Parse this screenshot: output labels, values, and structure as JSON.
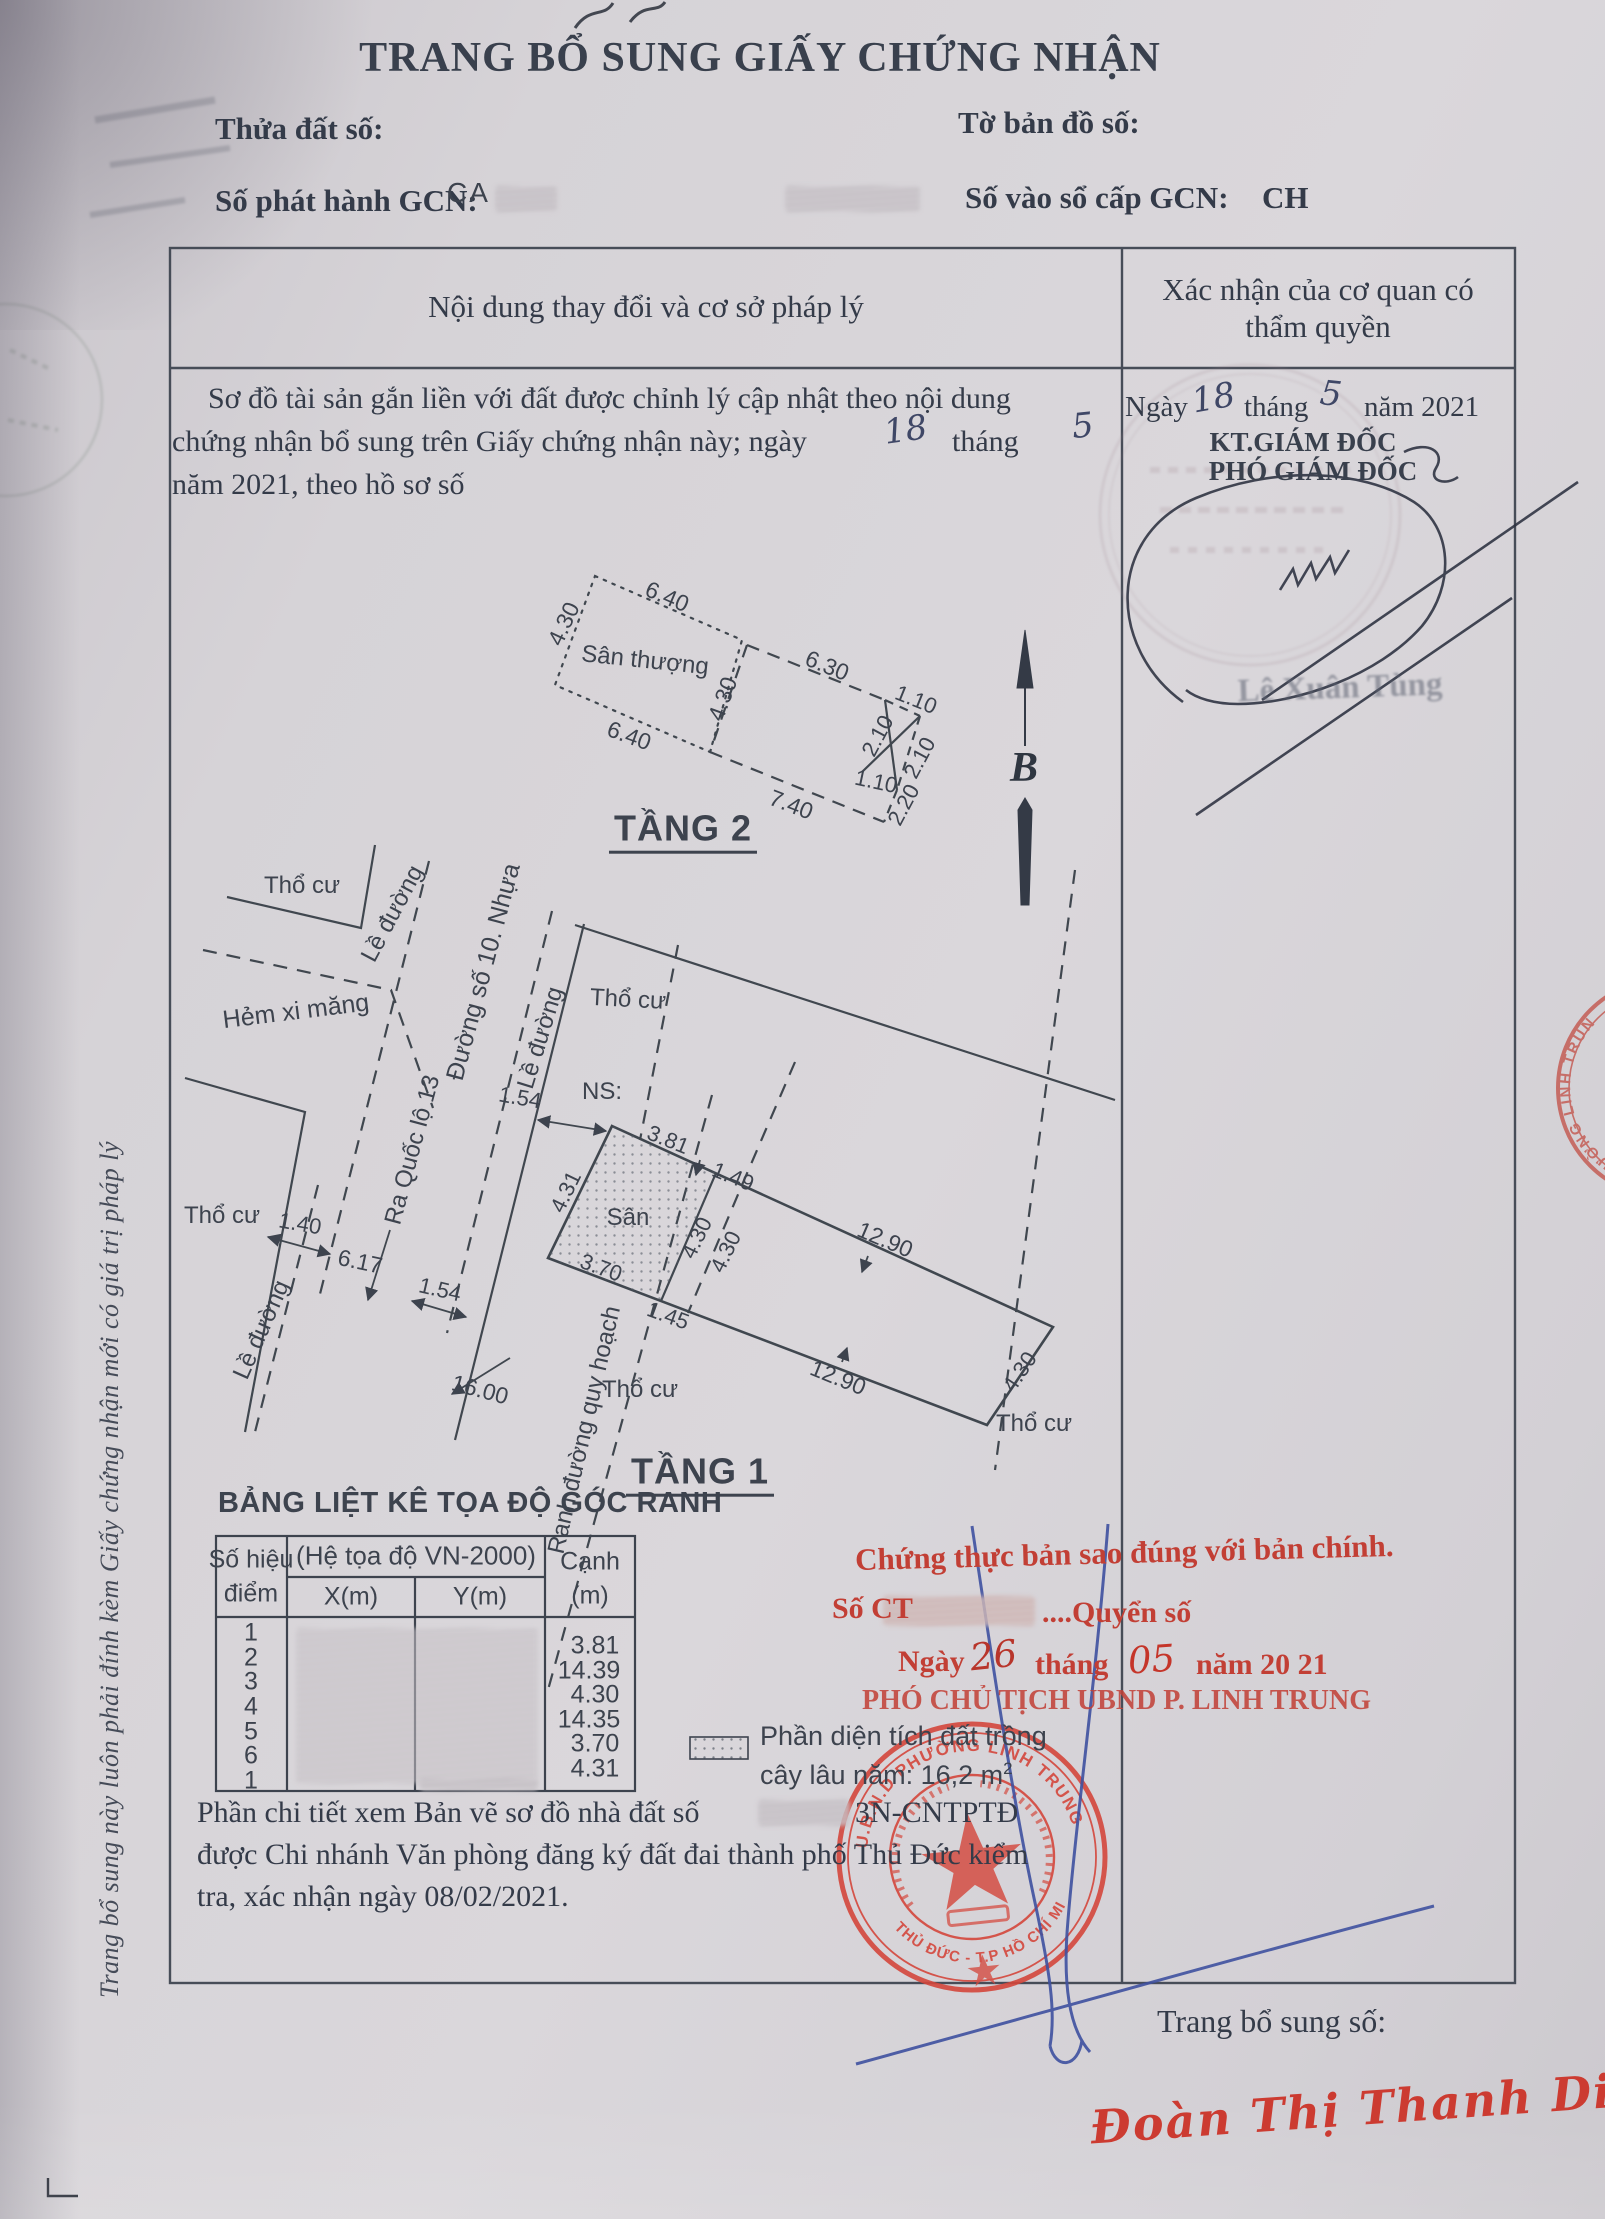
{
  "page": {
    "title": "TRANG BỔ SUNG GIẤY CHỨNG NHẬN",
    "footer_label": "Trang bổ sung số:",
    "side_note": "Trang bổ sung này luôn phải đính kèm Giấy chứng nhận mới có giá trị pháp lý"
  },
  "fields": {
    "thua_dat": "Thửa đất số:",
    "to_ban_do": "Tờ bản đồ số:",
    "so_phat_hanh": "Số phát hành GCN:",
    "so_phat_hanh_value": "CA",
    "so_vao_so": "Số vào sổ cấp GCN:",
    "so_vao_so_value": "CH"
  },
  "table": {
    "col_left": "Nội dung thay đổi và cơ sở pháp lý",
    "col_right_1": "Xác nhận của cơ quan có",
    "col_right_2": "thẩm quyền"
  },
  "entry": {
    "line1": "Sơ đồ tài sản gắn liền với đất được chỉnh lý cập nhật theo nội dung",
    "line2a": "chứng nhận bổ sung trên Giấy chứng nhận này; ngày",
    "hand_day": "18",
    "line2b": "tháng",
    "hand_month": "5",
    "line3": "năm 2021, theo hồ sơ số"
  },
  "approval": {
    "ngay": "Ngày",
    "day": "18",
    "thang": "tháng",
    "month": "5",
    "nam": "năm 2021",
    "kt": "KT.GIÁM ĐỐC",
    "pho": "PHÓ GIÁM ĐỐC",
    "signer": "Lê Xuân Tùng"
  },
  "plan2": {
    "title": "TẦNG 2",
    "room": "Sân thượng",
    "north": "B",
    "d": {
      "a640": "6.40",
      "a430": "4.30",
      "b640": "6.40",
      "b430": "4.30",
      "a630": "6.30",
      "a110": "1.10",
      "a210": "2.10",
      "b210": "2.10",
      "b110": "1.10",
      "a740": "7.40",
      "a220": "2.20"
    }
  },
  "plan1": {
    "title": "TẦNG 1",
    "tho_cu": "Thổ cư",
    "le_duong": "Lề đường",
    "hem": "Hẻm xi măng",
    "duong": "Đường số 10. Nhựa",
    "ra_quoc_lo": "Ra Quốc lộ 13",
    "ns": "NS:",
    "san": "Sân",
    "ranh": "Ranh đường quy hoạch",
    "d": {
      "a154": "1.54",
      "a381": "3.81",
      "a431": "4.31",
      "a149": "1.49",
      "a140": "1.40",
      "a617": "6.17",
      "b154": "1.54",
      "a370": "3.70",
      "a145": "1.45",
      "a430": "4.30",
      "b430": "4.30",
      "a1290": "12.90",
      "a1600": "16.00",
      "b1290": "12.90",
      "c430": "4.30"
    }
  },
  "coord_table": {
    "heading": "BẢNG LIỆT KÊ TỌA ĐỘ GÓC RANH",
    "col_point_1": "Số hiệu",
    "col_point_2": "điểm",
    "col_sys": "(Hệ tọa độ VN-2000)",
    "col_x": "X(m)",
    "col_y": "Y(m)",
    "col_canh_1": "Cạnh",
    "col_canh_2": "(m)",
    "points": [
      "1",
      "2",
      "3",
      "4",
      "5",
      "6",
      "1"
    ],
    "edges": [
      "3.81",
      "14.39",
      "4.30",
      "14.35",
      "3.70",
      "4.31"
    ]
  },
  "legend": {
    "line1": "Phần diện tích đất trồng",
    "line2": "cây lâu năm: 16,2 m",
    "sup": "2"
  },
  "note": {
    "line1": "Phần chi tiết xem Bản vẽ sơ đồ nhà đất số",
    "code": "3N-CNTPTĐ",
    "line2": "được Chi nhánh Văn phòng đăng ký đất đai thành phố Thủ Đức kiểm",
    "line3": "tra, xác nhận ngày 08/02/2021."
  },
  "cert": {
    "line1": "Chứng thực bản sao đúng với bản chính.",
    "so_ct": "Số CT",
    "quyen_so": "....Quyển số",
    "ngay": "Ngày",
    "day": "26",
    "thang": "tháng",
    "month": "05",
    "nam": "năm 20 21",
    "title": "PHÓ CHỦ TỊCH UBND P. LINH TRUNG",
    "stamp_name": "Đoàn Thị Thanh Diệp"
  },
  "seal": {
    "arc_top": "U.B.N.D PHƯỜNG LINH TRUNG",
    "arc_bottom": "T.P THỦ ĐỨC - T.P HỒ CHÍ MINH",
    "edge_arc": "ƯỜNG LINH TRUNG"
  }
}
